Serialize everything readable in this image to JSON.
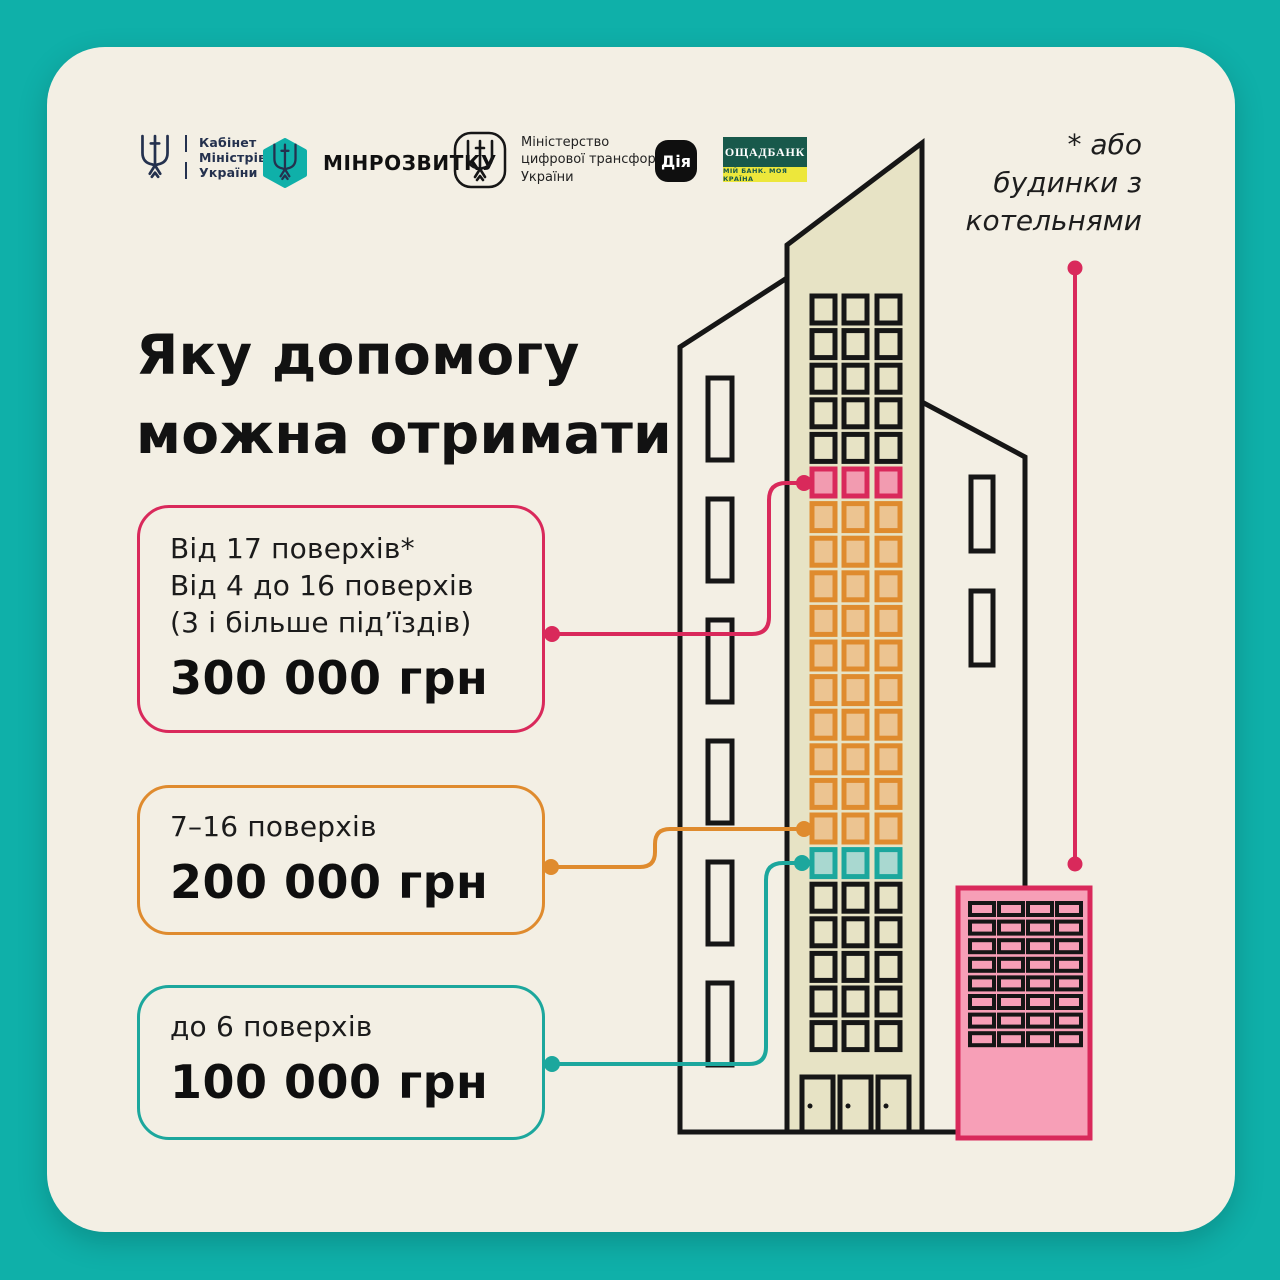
{
  "colors": {
    "bg_teal": "#0FB0A9",
    "card": "#F3EFE4",
    "ink": "#161616",
    "beige": "#E7E3C5",
    "crimson": "#D9295B",
    "pink_fill": "#F29BB0",
    "orange": "#DF8B2E",
    "orange_fill": "#ECC491",
    "teal": "#1CA79D",
    "teal_fill": "#A9D8D0",
    "boiler_fill": "#F79FB7",
    "navy": "#24314E",
    "oschad_green": "#18594B",
    "oschad_yellow": "#EDE73B",
    "diia_bg": "#0F0F0F"
  },
  "header": {
    "kmu": {
      "lines": [
        "Кабінет",
        "Міністрів",
        "України"
      ]
    },
    "minrozvytku": {
      "label": "МІНРОЗВИТКУ"
    },
    "mintsyfra": {
      "lines": [
        "Міністерство",
        "цифрової трансформації",
        "України"
      ]
    },
    "diia": {
      "label": "Дія"
    },
    "oschadbank": {
      "title": "ОЩАДБАНК",
      "subtitle": "МІЙ БАНК. МОЯ КРАЇНА"
    }
  },
  "title": {
    "line1": "Яку допомогу",
    "line2": "можна отримати"
  },
  "note": {
    "lines": [
      "* або",
      "будинки з",
      "котельнями"
    ]
  },
  "cards": [
    {
      "lines": [
        "Від 17 поверхів*",
        "Від 4 до 16 поверхів",
        "(3 і більше під’їздів)"
      ],
      "value": "300 000 грн",
      "accent": "#D9295B"
    },
    {
      "lines": [
        "7–16 поверхів"
      ],
      "value": "200 000 грн",
      "accent": "#DF8B2E"
    },
    {
      "lines": [
        "до 6 поверхів"
      ],
      "value": "100 000 грн",
      "accent": "#1CA79D"
    }
  ],
  "building": {
    "window_bands": [
      {
        "name": "upper-floors",
        "color": "black",
        "rows": 5
      },
      {
        "name": "floors-from-17",
        "color": "pink",
        "rows": 1
      },
      {
        "name": "floors-7-16",
        "color": "orange",
        "rows": 10
      },
      {
        "name": "floors-to-6",
        "color": "teal",
        "rows": 1
      },
      {
        "name": "lower-floors",
        "color": "black",
        "rows": 5
      }
    ],
    "boiler": {
      "cols": 4,
      "rows": 8
    }
  }
}
